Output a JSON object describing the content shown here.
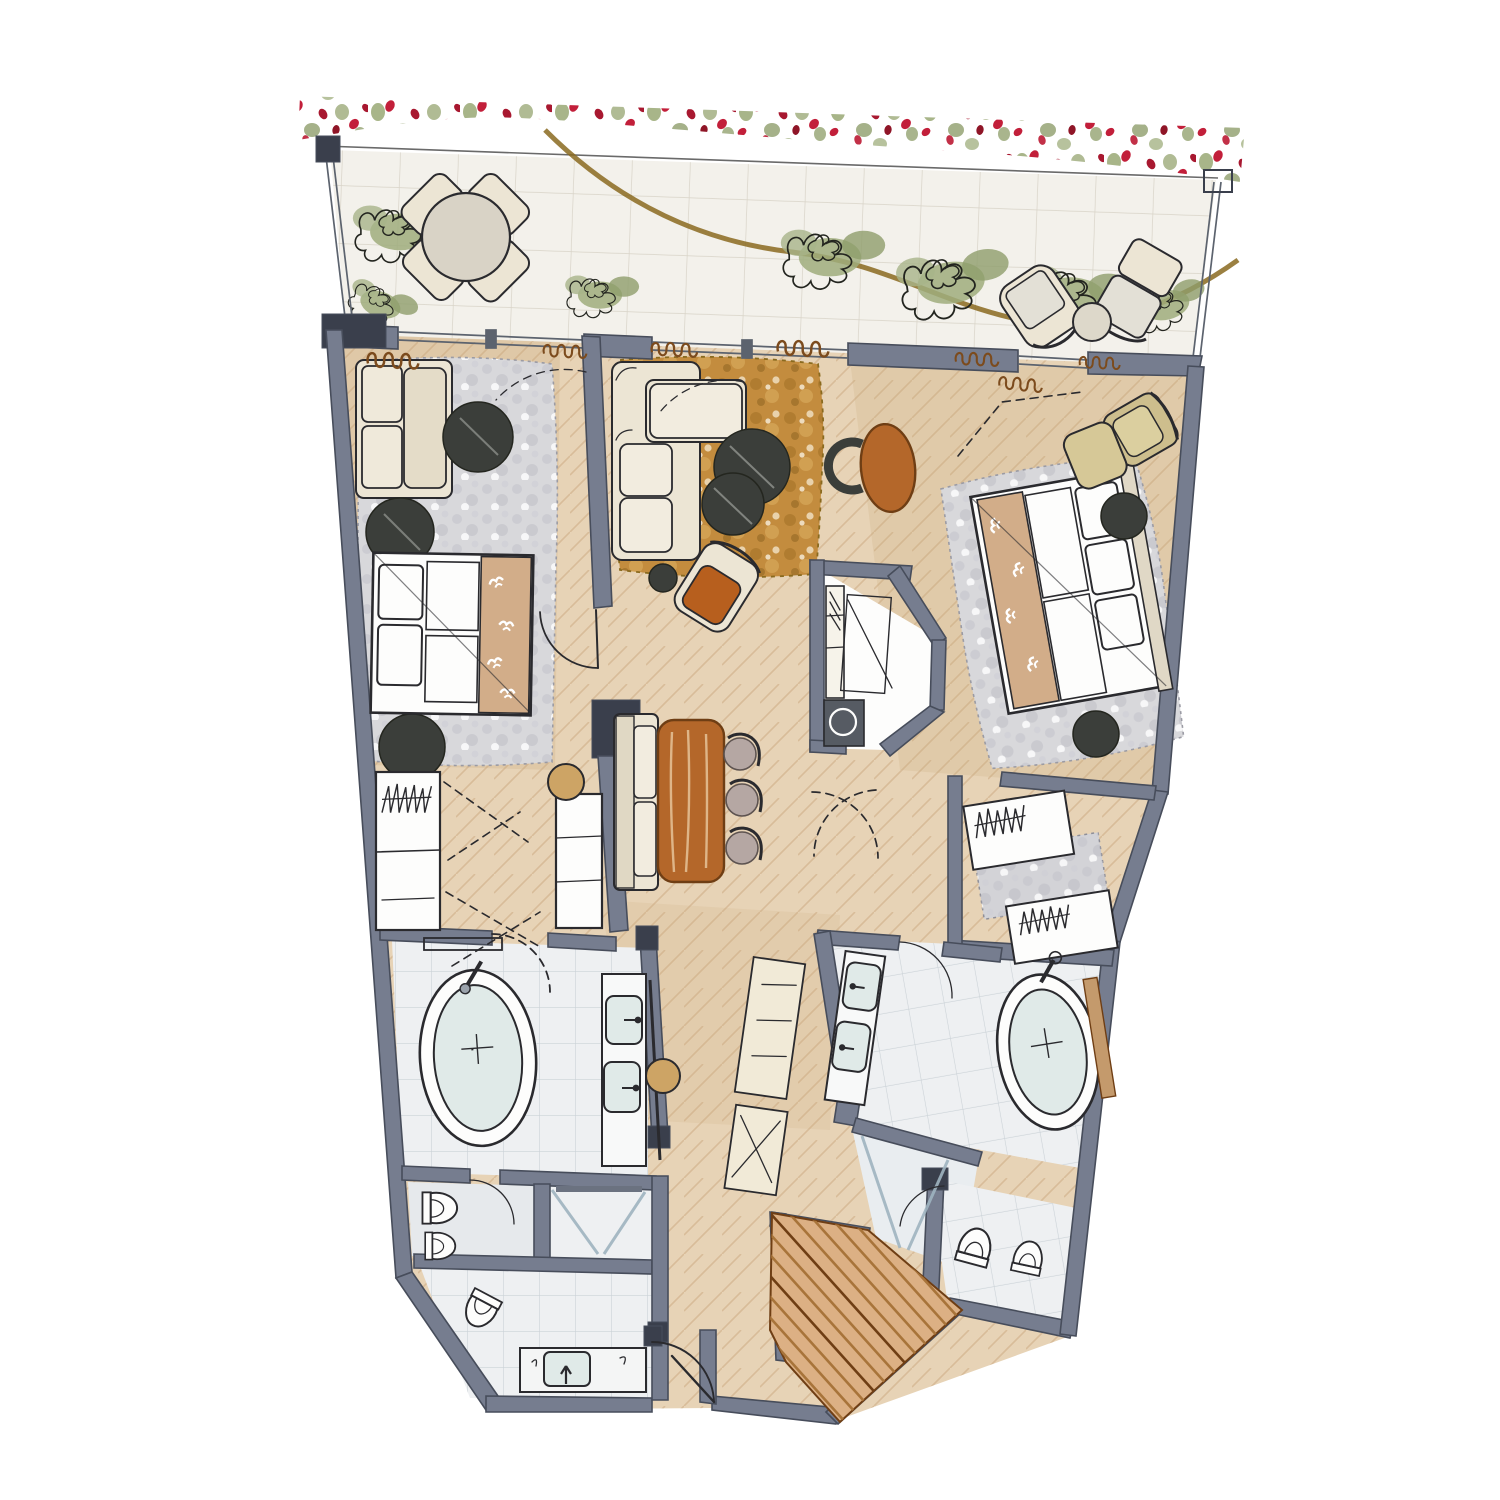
{
  "title": "Hand-drawn watercolor floor plan sketch of a two-bedroom suite with terrace",
  "palette": {
    "paper": "#ffffff",
    "ink": "#2a2a2e",
    "wall": "#767d8f",
    "wallDark": "#474d5b",
    "wallDarker": "#3a3f4c",
    "floorTan": "#e7d3b6",
    "floorLine": "#d0b18c",
    "floorWash": "#d3b globalization",
    "terraceTile": "#f3f1eb",
    "terraceLine": "#d8d3c7",
    "bathTile": "#eef0f2",
    "bathLine": "#ccd3d8",
    "rugGray": "#d8d8db",
    "rugGrayDot": "#bdbdc4",
    "rugGold": "#c38c3e",
    "rugGoldDark": "#9a6c25",
    "woodOrange": "#b4672a",
    "woodOrangeDark": "#6f3e14",
    "darkFurn": "#3b3e3a",
    "cream": "#ece5d4",
    "creamDark": "#d9d0ba",
    "tanRunner": "#d2ad89",
    "oliveChair": "#cdbe8d",
    "stoolTan": "#cda465",
    "mauveSeat": "#b5a7a3",
    "flowerRed": "#c21f3a",
    "flowerRedDark": "#8f1527",
    "leafGreen": "#9fad7c",
    "leafGreenDark": "#7e905f",
    "hedgeBrown": "#8a6a20",
    "curtainBrown": "#7c4b1d",
    "glassBlue": "#9fb4c0",
    "fixtureBlue": "#e0eae8",
    "stairWood": "#dcb084",
    "stairWoodDark": "#a8743a",
    "closetBeige": "#f1ead7"
  },
  "scene": {
    "type": "floor-plan-sketch",
    "style": "marker-and-watercolor",
    "areas": [
      {
        "name": "terrace",
        "items": [
          "flower-hedge",
          "round-dining-table",
          "four-terrace-chairs",
          "potted-plant",
          "two-lounge-chairs",
          "side-table",
          "railing"
        ]
      },
      {
        "name": "left-bedroom",
        "items": [
          "sofa",
          "shag-rug",
          "round-side-tables",
          "double-bed",
          "bird-motif-runner",
          "wardrobes",
          "stool"
        ]
      },
      {
        "name": "living-room",
        "items": [
          "l-shaped-sofa",
          "gold-rug",
          "two-round-coffee-tables",
          "armchair",
          "side-table",
          "desk",
          "desk-chair"
        ]
      },
      {
        "name": "dining",
        "items": [
          "bench",
          "wood-table",
          "three-chairs"
        ]
      },
      {
        "name": "kitchenette",
        "items": [
          "counter",
          "round-sink"
        ]
      },
      {
        "name": "right-bedroom",
        "items": [
          "double-bed",
          "bird-motif-runner",
          "shag-rug",
          "round-nightstands",
          "lounge-chair",
          "ottoman",
          "walk-in-closet"
        ]
      },
      {
        "name": "left-bathroom",
        "items": [
          "freestanding-tub",
          "double-vanity",
          "toilet",
          "bidet",
          "shower",
          "second-wc",
          "washbasin"
        ]
      },
      {
        "name": "right-bathroom",
        "items": [
          "freestanding-tub",
          "double-vanity",
          "shower",
          "toilet",
          "bidet"
        ]
      },
      {
        "name": "entry",
        "items": [
          "entry-door",
          "wood-steps"
        ]
      }
    ]
  }
}
